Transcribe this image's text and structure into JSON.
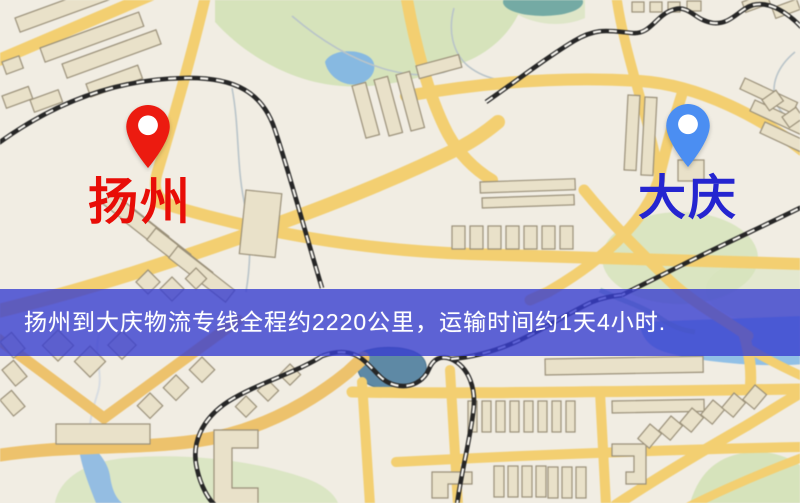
{
  "markers": {
    "origin": {
      "name": "扬州",
      "pin_color": "#ec1b10",
      "label_color": "#e80d07"
    },
    "destination": {
      "name": "大庆",
      "pin_color": "#4b8ef2",
      "label_color": "#2525d0"
    }
  },
  "banner": {
    "text": "扬州到大庆物流专线全程约2220公里，运输时间约1天4小时.",
    "background_color": "#383ed0",
    "text_color": "#ffffff"
  },
  "map_palette": {
    "background": "#f1ede3",
    "road_yellow": "#f4cf6d",
    "road_orange": "#efc268",
    "building_fill": "#e9e1c8",
    "building_outline": "#9a9078",
    "park_green": "#d6e3ba",
    "water_blue": "#8fc0e8",
    "pond_dark": "#5d89a6",
    "railway_dark": "#262626"
  }
}
